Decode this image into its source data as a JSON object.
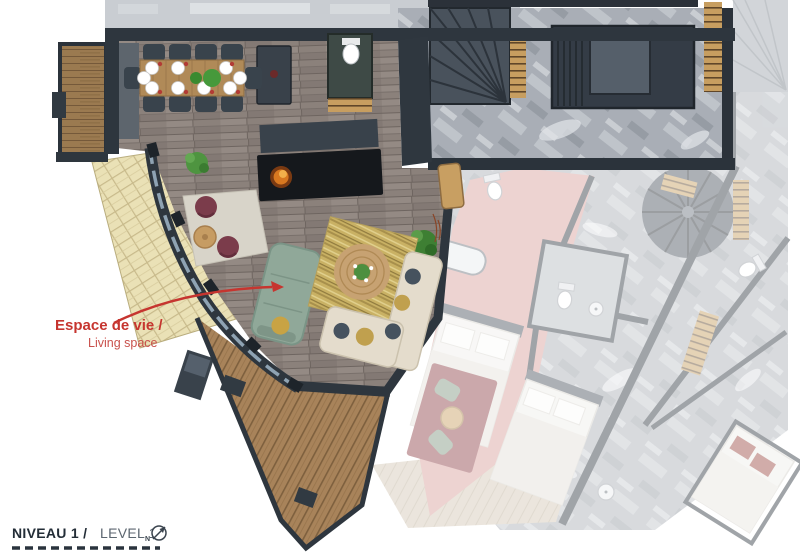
{
  "page": {
    "background": "#ffffff",
    "kind": "architectural floor plan rendering"
  },
  "footer": {
    "level_label_fr": "NIVEAU 1 /",
    "level_label_en": "LEVEL 1",
    "compass_letter": "N"
  },
  "annotations": {
    "living_space": {
      "label_fr": "Espace de vie /",
      "label_en": "Living space",
      "color": "#c6352f"
    }
  },
  "palette": {
    "wall_charcoal": "#2e363e",
    "wood_floor": "#8b817b",
    "deck_wood": "#a8835a",
    "roof_shingles": "#eae1b6",
    "sofa_sage": "#90a899",
    "sofa_beige": "#e4dccc",
    "carpet_olive": "#c9b164",
    "rug_jute": "#c7a272",
    "pouf_burgundy": "#7b3c4b",
    "fire_orange": "#e08a2f",
    "neighbor_pink_carpet": "#d89f9b",
    "faded_stone": "#a9aeb6",
    "accent_red": "#c6352f"
  }
}
